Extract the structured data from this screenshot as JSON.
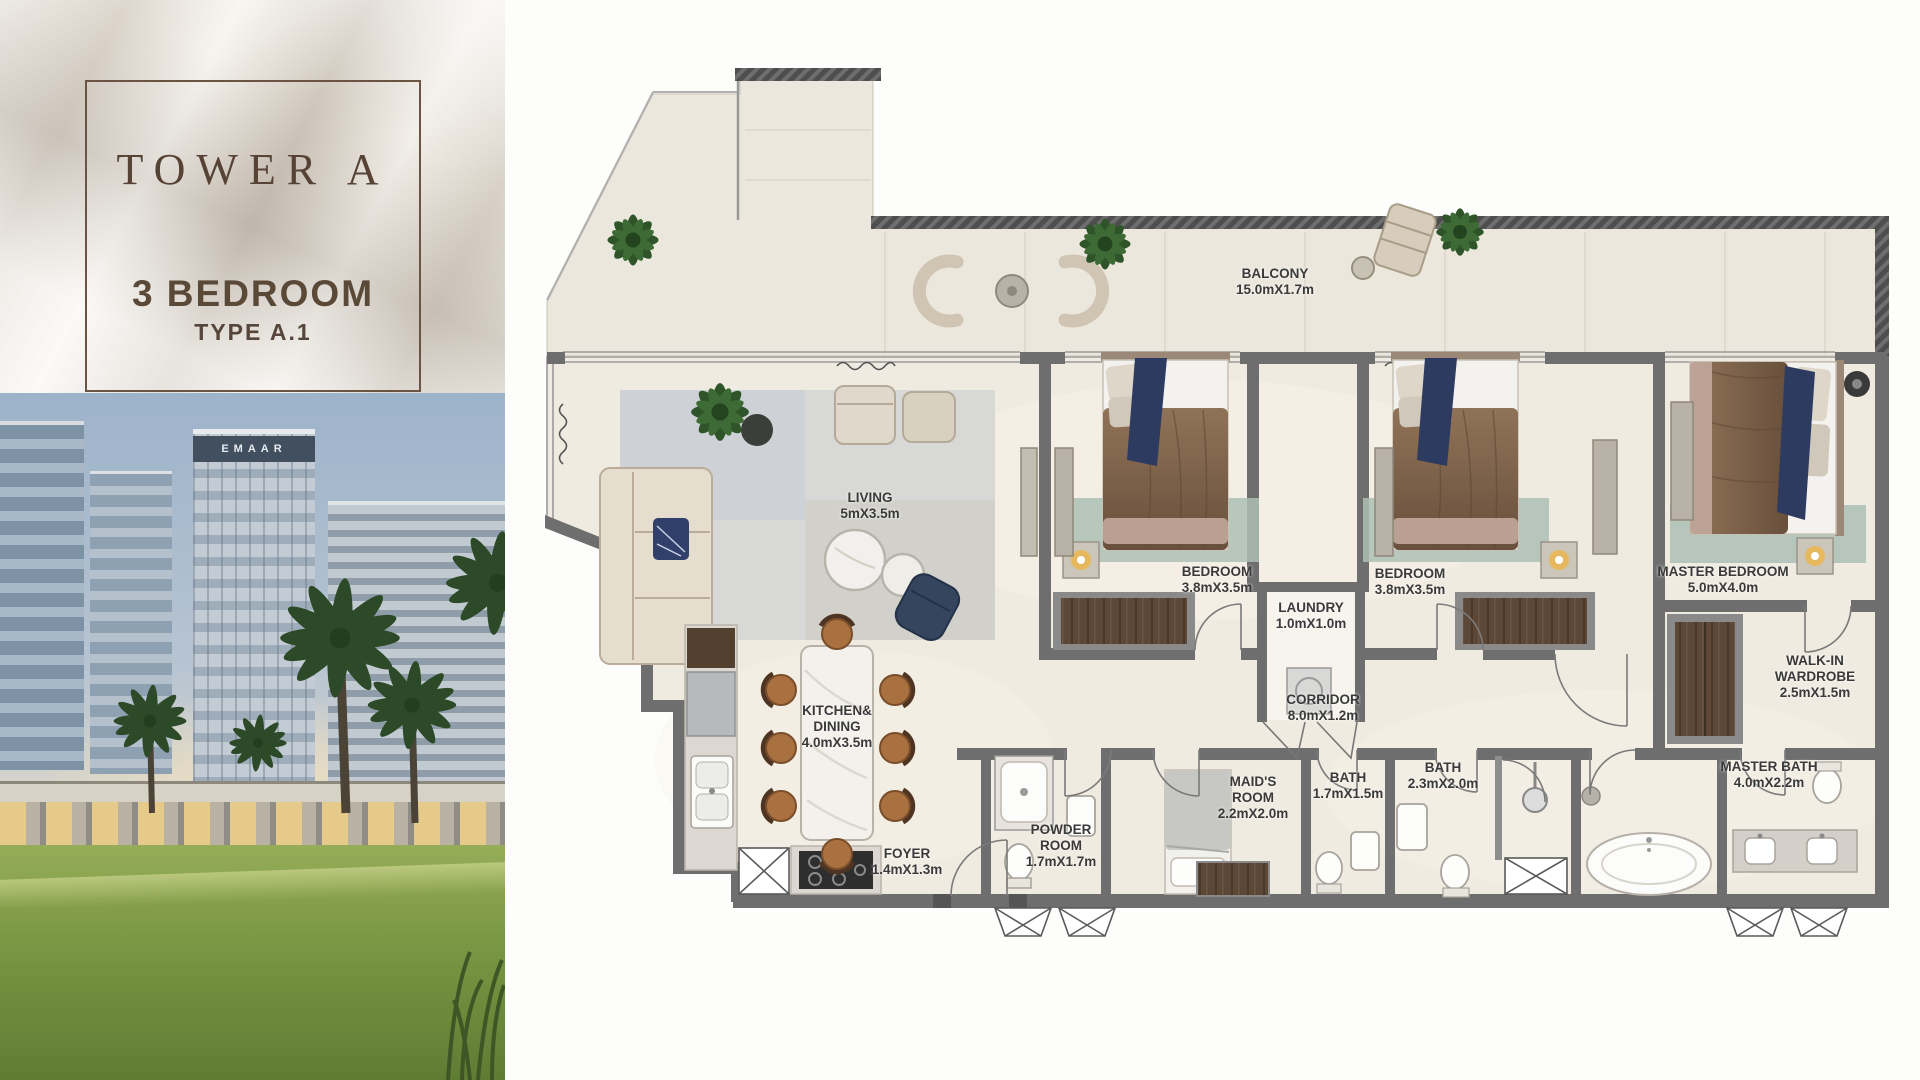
{
  "title_panel": {
    "tower": "TOWER A",
    "bedrooms": "3 BEDROOM",
    "type": "TYPE A.1"
  },
  "photo": {
    "building_brand": "EMAAR"
  },
  "floor_plan": {
    "rooms": [
      {
        "id": "balcony",
        "name": "BALCONY",
        "dims": "15.0mX1.7m"
      },
      {
        "id": "living",
        "name": "LIVING",
        "dims": "5mX3.5m"
      },
      {
        "id": "bedroom-1",
        "name": "BEDROOM",
        "dims": "3.8mX3.5m"
      },
      {
        "id": "laundry",
        "name": "LAUNDRY",
        "dims": "1.0mX1.0m"
      },
      {
        "id": "bedroom-2",
        "name": "BEDROOM",
        "dims": "3.8mX3.5m"
      },
      {
        "id": "master-bedroom",
        "name": "MASTER BEDROOM",
        "dims": "5.0mX4.0m"
      },
      {
        "id": "corridor",
        "name": "CORRIDOR",
        "dims": "8.0mX1.2m"
      },
      {
        "id": "kitchen-dining",
        "name": "KITCHEN& DINING",
        "dims": "4.0mX3.5m"
      },
      {
        "id": "walk-in-wardrobe",
        "name": "WALK-IN WARDROBE",
        "dims": "2.5mX1.5m"
      },
      {
        "id": "foyer",
        "name": "FOYER",
        "dims": "1.4mX1.3m"
      },
      {
        "id": "powder-room",
        "name": "POWDER ROOM",
        "dims": "1.7mX1.7m"
      },
      {
        "id": "maids-room",
        "name": "MAID'S ROOM",
        "dims": "2.2mX2.0m"
      },
      {
        "id": "bath-1",
        "name": "BATH",
        "dims": "1.7mX1.5m"
      },
      {
        "id": "bath-2",
        "name": "BATH",
        "dims": "2.3mX2.0m"
      },
      {
        "id": "master-bath",
        "name": "MASTER BATH",
        "dims": "4.0mX2.2m"
      }
    ],
    "colors": {
      "title_text": "#5a463a",
      "label_text": "#3a3a3a",
      "wall": "#6e6e6e",
      "floor": "#f0ebe1",
      "balcony_floor": "#ece7dd",
      "wood": "#5d4736",
      "plant_green": "#2f5429",
      "navy_accent": "#2e3b60",
      "lawn_green": "#7d9a46",
      "sky_blue": "#9db3ca"
    }
  }
}
